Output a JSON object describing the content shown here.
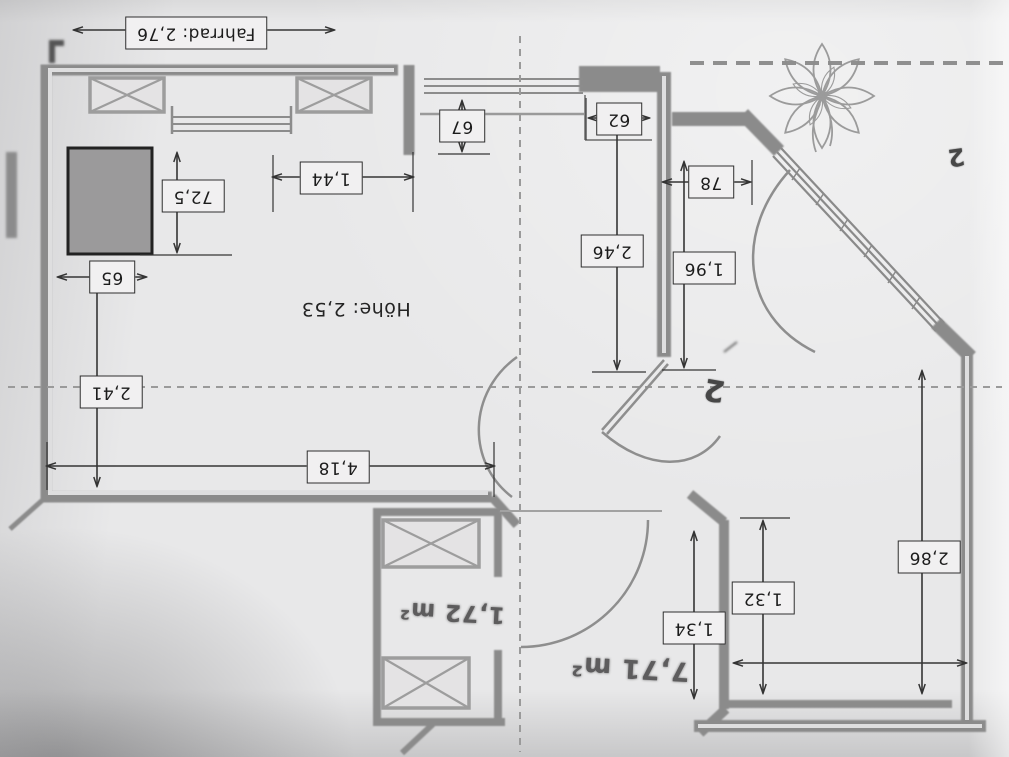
{
  "labels": {
    "bike_width": "Fahrrad: 2,76",
    "height_note": "Höhe: 2,53",
    "dim_72_5": "72,5",
    "dim_65": "65",
    "dim_1_44": "1,44",
    "dim_67": "67",
    "dim_62": "62",
    "dim_2_46": "2,46",
    "dim_78": "78",
    "dim_1_96": "1,96",
    "dim_2_41": "2,41",
    "dim_4_18": "4,18",
    "dim_2_86": "2,86",
    "dim_1_32": "1,32",
    "dim_1_34": "1,34",
    "area_small_room": "1,72 m²",
    "area_large_room": "7,71 m²",
    "handwritten_right": "2",
    "handwritten_center": "2"
  },
  "colors": {
    "paper": "#e8e8e9",
    "wall_gray": "#8b8b8b",
    "dimension_line": "#353535",
    "cabinet_fill": "#9b9a9b",
    "dashed_line": "#9a9a9a"
  }
}
